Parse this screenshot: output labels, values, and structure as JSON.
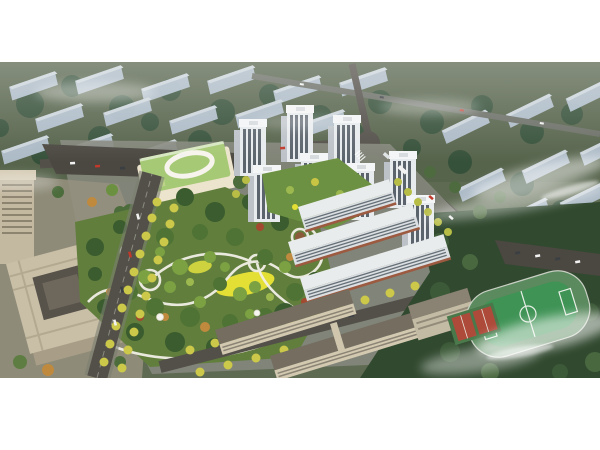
{
  "scene": {
    "type": "aerial-architectural-rendering",
    "subject": "Bird's-eye rendering of a residential development: central park, white high-rise towers, mid-rise retail slabs, kindergarten with green roof, beige office block, school campus with running track, tree-lined avenues, faded low-rise city blocks behind, drifting fog",
    "palette": {
      "ground": "#57644c",
      "developmentGround": "#85877c",
      "backgroundSlab": "#b5c3d2",
      "backgroundSlabTop": "#d6dfe8",
      "darkTree": "#35503a",
      "midTree": "#4f7334",
      "lightTree": "#7ba143",
      "accentTree": "#9cb84e",
      "autumnTree": "#c08a3e",
      "redTree": "#a2492f",
      "streetTree": "#ccc84a",
      "road": "#534f49",
      "roadFaded": "#6b6f66",
      "parkingLot": "#4b4741",
      "parkBase": "#617e3d",
      "parkLawn": "#e4df35",
      "parkPath": "#f2efe6",
      "towerFacade": "#e8ebed",
      "towerSide": "#bcc2c8",
      "towerWindow": "#5b636c",
      "slabRoof": "#e9ecec",
      "slabFacade": "#dbdfe2",
      "slabLine": "#667077",
      "retailStrip": "#9c5a40",
      "kindergartenRoof": "#a6c975",
      "kindergartenBody": "#ece4cc",
      "officeRoof": "#c9bfa7",
      "officeSide": "#a89e87",
      "officeCourt": "#57524a",
      "plaza": "#97917f",
      "schoolRoof": "#746d60",
      "schoolWall": "#d2c9b0",
      "track": "#5a8a5e",
      "pitch": "#3f9355",
      "courtRed": "#ad4a3a",
      "courtGreen": "#49794a",
      "fog": "#ffffff"
    }
  }
}
